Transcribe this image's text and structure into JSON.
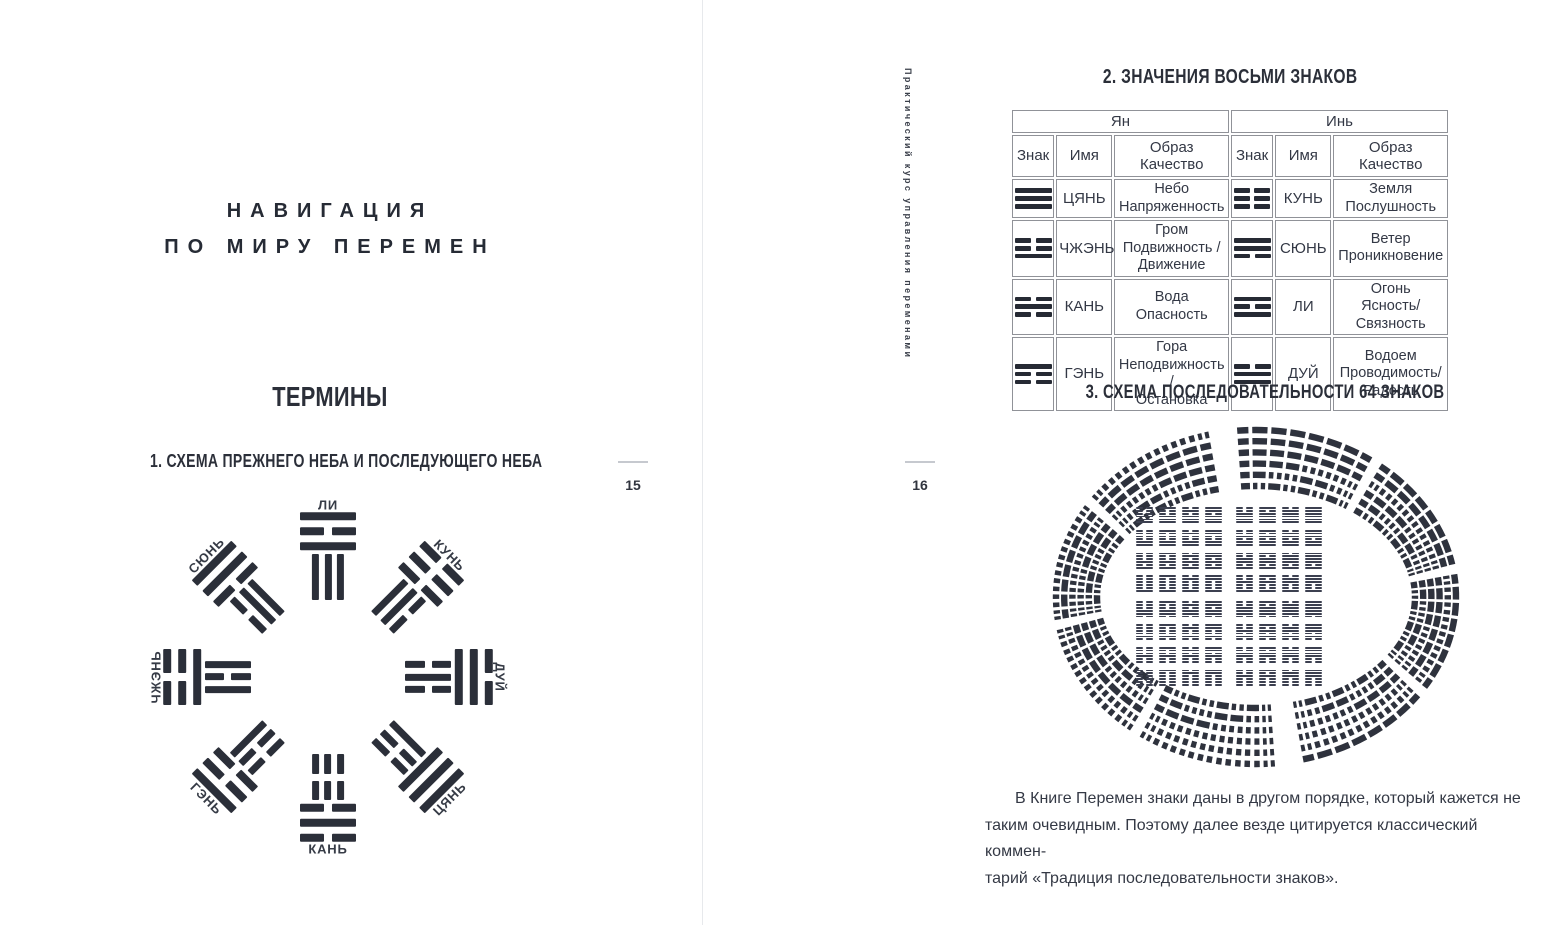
{
  "ink_color": "#2b2f39",
  "left_page": {
    "page_number": "15",
    "chapter_title_line1": "НАВИГАЦИЯ",
    "chapter_title_line2": "ПО МИРУ ПЕРЕМЕН",
    "section_title": "ТЕРМИНЫ",
    "figure1_title": "1. СХЕМА ПРЕЖНЕГО НЕБА И ПОСЛЕДУЮЩЕГО НЕБА",
    "bagua": {
      "note": "outer ring = Later Heaven labels, inner ring = Earlier Heaven trigrams; lines listed top-to-bottom, 1=solid yang, 0=broken yin",
      "positions": [
        {
          "angle": 0,
          "label": "ЛИ",
          "outer": [
            1,
            0,
            1
          ],
          "inner": [
            1,
            1,
            1
          ],
          "flip_label": false
        },
        {
          "angle": 45,
          "label": "КУНЬ",
          "outer": [
            0,
            0,
            0
          ],
          "inner": [
            1,
            1,
            0
          ],
          "flip_label": false
        },
        {
          "angle": 90,
          "label": "ДУЙ",
          "outer": [
            0,
            1,
            1
          ],
          "inner": [
            0,
            1,
            0
          ],
          "flip_label": false
        },
        {
          "angle": 135,
          "label": "ЦЯНЬ",
          "outer": [
            1,
            1,
            1
          ],
          "inner": [
            1,
            0,
            0
          ],
          "flip_label": true
        },
        {
          "angle": 180,
          "label": "КАНЬ",
          "outer": [
            0,
            1,
            0
          ],
          "inner": [
            0,
            0,
            0
          ],
          "flip_label": true
        },
        {
          "angle": 225,
          "label": "ГЭНЬ",
          "outer": [
            1,
            0,
            0
          ],
          "inner": [
            0,
            0,
            1
          ],
          "flip_label": true
        },
        {
          "angle": 270,
          "label": "ЧЖЭНЬ",
          "outer": [
            0,
            0,
            1
          ],
          "inner": [
            1,
            0,
            1
          ],
          "flip_label": false
        },
        {
          "angle": 315,
          "label": "СЮНЬ",
          "outer": [
            1,
            1,
            0
          ],
          "inner": [
            0,
            1,
            1
          ],
          "flip_label": false
        }
      ]
    }
  },
  "right_page": {
    "page_number": "16",
    "sidebar_text": "Практический курс управления переменами",
    "table_title": "2. ЗНАЧЕНИЯ ВОСЬМИ ЗНАКОВ",
    "table": {
      "group_headers": [
        "Ян",
        "Инь"
      ],
      "column_headers": [
        "Знак",
        "Имя",
        "Образ\nКачество"
      ],
      "yan_rows": [
        {
          "lines": [
            1,
            1,
            1
          ],
          "name": "ЦЯНЬ",
          "meaning": "Небо\nНапряженность"
        },
        {
          "lines": [
            0,
            0,
            1
          ],
          "name": "ЧЖЭНЬ",
          "meaning": "Гром\nПодвижность /\nДвижение"
        },
        {
          "lines": [
            0,
            1,
            0
          ],
          "name": "КАНЬ",
          "meaning": "Вода\nОпасность"
        },
        {
          "lines": [
            1,
            0,
            0
          ],
          "name": "ГЭНЬ",
          "meaning": "Гора\nНеподвижность /\nОстановка"
        }
      ],
      "yin_rows": [
        {
          "lines": [
            0,
            0,
            0
          ],
          "name": "КУНЬ",
          "meaning": "Земля\nПослушность"
        },
        {
          "lines": [
            1,
            1,
            0
          ],
          "name": "СЮНЬ",
          "meaning": "Ветер\nПроникновение"
        },
        {
          "lines": [
            1,
            0,
            1
          ],
          "name": "ЛИ",
          "meaning": "Огонь\nЯсность/Связность"
        },
        {
          "lines": [
            0,
            1,
            1
          ],
          "name": "ДУЙ",
          "meaning": "Водоем\nПроводимость/\nРадость"
        }
      ]
    },
    "figure3_title": "3. СХЕМА ПОСЛЕДОВАТЕЛЬНОСТИ 64 ЗНАКОВ",
    "circle_diagram": {
      "hexagram_count": 64,
      "rings": 6,
      "arrangement": "fuxi-binary",
      "right_half": "Цянь(111111) у верхнего разрыва по часовой стрелке до Фу(100000) у нижнего",
      "left_half": "Гоу(011111) у верхнего разрыва против часовой стрелки до Кунь(000000) у нижнего",
      "inner_grid": {
        "rows": 8,
        "cols": 8,
        "order": "Тай…Цянь сверху, Кунь…Пи снизу (двоичный порядок)"
      }
    },
    "paragraph": "В Книге Перемен знаки даны в другом порядке, который кажется не\nтаким очевидным. Поэтому далее везде цитируется классический коммен-\nтарий «Традиция последовательности знаков»."
  }
}
